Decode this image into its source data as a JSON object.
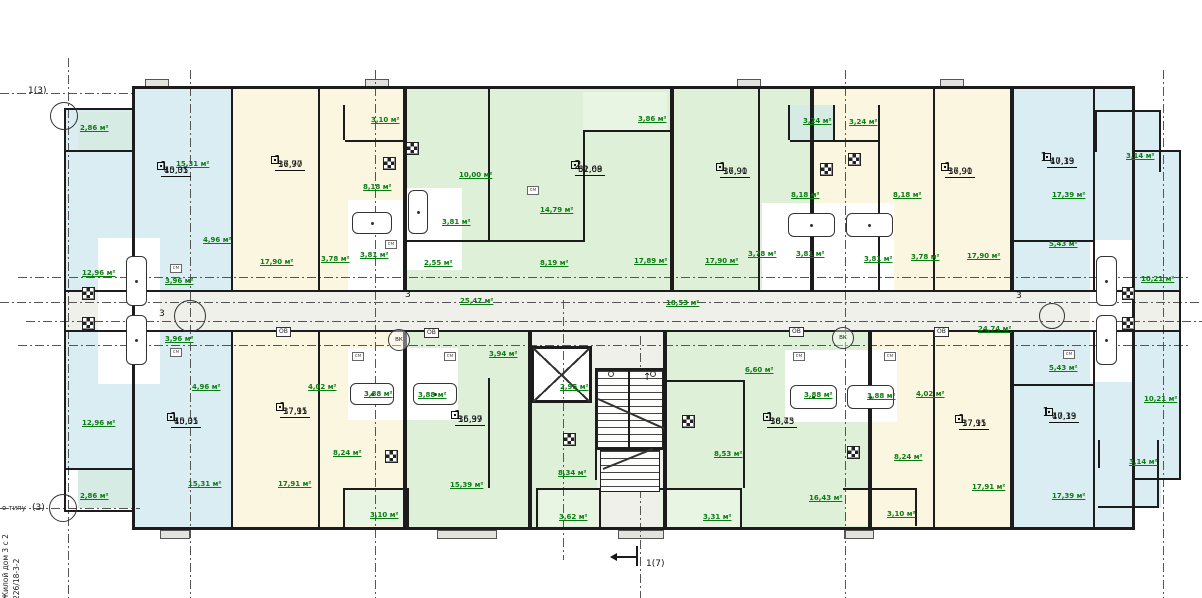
{
  "palette": {
    "blue": "#daedf3",
    "cream": "#faf6df",
    "green": "#def0d8",
    "mint": "#e8f5e3",
    "teal": "#d6ebe4",
    "gray": "#f0f0ea",
    "white": "#ffffff",
    "stub": "#e3e3de",
    "wall": "#1c1c1c",
    "label": "#0a7d12"
  },
  "title_block": {
    "side_line1": "Жилой дом 3 с 2",
    "side_line2": "226/18-3-2",
    "type_note": "о типу"
  },
  "lift": {
    "line1": "Лифт Q=630кг",
    "line2": "(АР-1н)"
  },
  "dim_label": "1.680",
  "tags": {
    "ov": "ОВ",
    "vk": "ВК",
    "sm": "см",
    "ztr": "ЗТР",
    "ov_pos": [
      [
        276,
        327
      ],
      [
        424,
        328
      ],
      [
        789,
        327
      ],
      [
        934,
        327
      ]
    ],
    "vk_pos": [
      [
        388,
        329
      ],
      [
        832,
        327
      ]
    ],
    "sm_pos": [
      [
        385,
        240
      ],
      [
        527,
        186
      ],
      [
        170,
        264
      ],
      [
        170,
        348
      ],
      [
        352,
        352
      ],
      [
        444,
        352
      ],
      [
        793,
        352
      ],
      [
        884,
        352
      ],
      [
        1063,
        350
      ]
    ]
  },
  "apartments": [
    {
      "n": "1",
      "a1": "15,31",
      "a2": "40,05",
      "x": 160,
      "y": 166,
      "side": "left"
    },
    {
      "n": "1",
      "a1": "17,90",
      "a2": "36,77",
      "x": 274,
      "y": 160,
      "side": "left"
    },
    {
      "n": "2",
      "a1": "32,68",
      "a2": "61,09",
      "x": 574,
      "y": 165,
      "side": "left"
    },
    {
      "n": "1",
      "a1": "17,90",
      "a2": "36,91",
      "x": 719,
      "y": 167,
      "side": "left"
    },
    {
      "n": "1",
      "a1": "17,90",
      "a2": "36,91",
      "x": 944,
      "y": 167,
      "side": "left"
    },
    {
      "n": "1",
      "a1": "17,39",
      "a2": "40,13",
      "x": 1048,
      "y": 157,
      "side": "right"
    },
    {
      "n": "1",
      "a1": "15,31",
      "a2": "40,05",
      "x": 170,
      "y": 417,
      "side": "left"
    },
    {
      "n": "1",
      "a1": "17,91",
      "a2": "37,15",
      "x": 279,
      "y": 407,
      "side": "left"
    },
    {
      "n": "1",
      "a1": "15,99",
      "a2": "36,37",
      "x": 454,
      "y": 415,
      "side": "left"
    },
    {
      "n": "1",
      "a1": "16,43",
      "a2": "38,75",
      "x": 766,
      "y": 417,
      "side": "left"
    },
    {
      "n": "1",
      "a1": "17,91",
      "a2": "37,15",
      "x": 958,
      "y": 419,
      "side": "left"
    },
    {
      "n": "1",
      "a1": "17,39",
      "a2": "40,13",
      "x": 1050,
      "y": 412,
      "side": "right"
    }
  ],
  "area_labels": [
    {
      "t": "2,86 м²",
      "x": 80,
      "y": 124
    },
    {
      "t": "15,31 м²",
      "x": 176,
      "y": 160
    },
    {
      "t": "4,96 м²",
      "x": 203,
      "y": 236
    },
    {
      "t": "12,96 м²",
      "x": 82,
      "y": 269
    },
    {
      "t": "3,96 м²",
      "x": 165,
      "y": 277
    },
    {
      "t": "3,10 м²",
      "x": 371,
      "y": 116
    },
    {
      "t": "8,18 м²",
      "x": 363,
      "y": 183
    },
    {
      "t": "17,90 м²",
      "x": 260,
      "y": 258
    },
    {
      "t": "3,78 м²",
      "x": 321,
      "y": 255
    },
    {
      "t": "3,81 м²",
      "x": 360,
      "y": 251
    },
    {
      "t": "10,00 м²",
      "x": 459,
      "y": 171
    },
    {
      "t": "3,86 м²",
      "x": 638,
      "y": 115
    },
    {
      "t": "14,79 м²",
      "x": 540,
      "y": 206
    },
    {
      "t": "3,81 м²",
      "x": 442,
      "y": 218
    },
    {
      "t": "2,55 м²",
      "x": 424,
      "y": 259
    },
    {
      "t": "8,19 м²",
      "x": 540,
      "y": 259
    },
    {
      "t": "17,89 м²",
      "x": 634,
      "y": 257
    },
    {
      "t": "25,47 м²",
      "x": 460,
      "y": 297
    },
    {
      "t": "18,53 м²",
      "x": 666,
      "y": 299
    },
    {
      "t": "24,74 м²",
      "x": 978,
      "y": 325
    },
    {
      "t": "3,24 м²",
      "x": 803,
      "y": 117
    },
    {
      "t": "3,24 м²",
      "x": 849,
      "y": 118
    },
    {
      "t": "8,18 м²",
      "x": 791,
      "y": 191
    },
    {
      "t": "8,18 м²",
      "x": 893,
      "y": 191
    },
    {
      "t": "17,90 м²",
      "x": 705,
      "y": 257
    },
    {
      "t": "3,78 м²",
      "x": 748,
      "y": 250
    },
    {
      "t": "3,81 м²",
      "x": 796,
      "y": 250
    },
    {
      "t": "3,81 м²",
      "x": 864,
      "y": 255
    },
    {
      "t": "3,78 м²",
      "x": 911,
      "y": 253
    },
    {
      "t": "17,90 м²",
      "x": 967,
      "y": 252
    },
    {
      "t": "17,39 м²",
      "x": 1052,
      "y": 191
    },
    {
      "t": "3,14 м²",
      "x": 1126,
      "y": 152
    },
    {
      "t": "5,43 м²",
      "x": 1049,
      "y": 240
    },
    {
      "t": "10,21 м²",
      "x": 1141,
      "y": 275
    },
    {
      "t": "2,95 м²",
      "x": 560,
      "y": 383
    },
    {
      "t": "3,96 м²",
      "x": 165,
      "y": 335
    },
    {
      "t": "4,96 м²",
      "x": 192,
      "y": 383
    },
    {
      "t": "12,96 м²",
      "x": 82,
      "y": 419
    },
    {
      "t": "15,31 м²",
      "x": 188,
      "y": 480
    },
    {
      "t": "2,86 м²",
      "x": 80,
      "y": 492
    },
    {
      "t": "4,02 м²",
      "x": 308,
      "y": 383
    },
    {
      "t": "3,88 м²",
      "x": 364,
      "y": 390
    },
    {
      "t": "3,88 м²",
      "x": 418,
      "y": 391
    },
    {
      "t": "8,24 м²",
      "x": 333,
      "y": 449
    },
    {
      "t": "17,91 м²",
      "x": 278,
      "y": 480
    },
    {
      "t": "3,10 м²",
      "x": 370,
      "y": 511
    },
    {
      "t": "3,94 м²",
      "x": 489,
      "y": 350
    },
    {
      "t": "15,39 м²",
      "x": 450,
      "y": 481
    },
    {
      "t": "8,34 м²",
      "x": 558,
      "y": 469
    },
    {
      "t": "3,62 м²",
      "x": 559,
      "y": 513
    },
    {
      "t": "6,60 м²",
      "x": 745,
      "y": 366
    },
    {
      "t": "8,53 м²",
      "x": 714,
      "y": 450
    },
    {
      "t": "16,43 м²",
      "x": 809,
      "y": 494
    },
    {
      "t": "3,31 м²",
      "x": 703,
      "y": 513
    },
    {
      "t": "3,88 м²",
      "x": 804,
      "y": 391
    },
    {
      "t": "3,88 м²",
      "x": 867,
      "y": 392
    },
    {
      "t": "4,02 м²",
      "x": 916,
      "y": 390
    },
    {
      "t": "8,24 м²",
      "x": 894,
      "y": 453
    },
    {
      "t": "17,91 м²",
      "x": 972,
      "y": 483
    },
    {
      "t": "3,10 м²",
      "x": 887,
      "y": 510
    },
    {
      "t": "17,39 м²",
      "x": 1052,
      "y": 492
    },
    {
      "t": "5,43 м²",
      "x": 1049,
      "y": 364
    },
    {
      "t": "10,21 м²",
      "x": 1144,
      "y": 395
    },
    {
      "t": "3,14 м²",
      "x": 1129,
      "y": 458
    }
  ],
  "zones": [
    [
      66,
      108,
      66,
      184,
      "blue"
    ],
    [
      132,
      88,
      101,
      204,
      "blue"
    ],
    [
      233,
      88,
      172,
      204,
      "cream"
    ],
    [
      405,
      88,
      267,
      204,
      "green"
    ],
    [
      672,
      88,
      140,
      204,
      "green"
    ],
    [
      812,
      88,
      200,
      204,
      "cream"
    ],
    [
      1012,
      88,
      123,
      204,
      "blue"
    ],
    [
      1135,
      150,
      46,
      142,
      "blue"
    ],
    [
      1095,
      110,
      66,
      62,
      "blue"
    ],
    [
      78,
      112,
      54,
      38,
      "teal"
    ],
    [
      345,
      105,
      62,
      35,
      "cream"
    ],
    [
      583,
      92,
      84,
      38,
      "mint"
    ],
    [
      790,
      105,
      45,
      35,
      "teal"
    ],
    [
      835,
      105,
      45,
      35,
      "cream"
    ],
    [
      132,
      292,
      1003,
      40,
      "gray"
    ],
    [
      66,
      292,
      66,
      40,
      "gray"
    ],
    [
      1135,
      292,
      46,
      40,
      "gray"
    ],
    [
      66,
      332,
      66,
      138,
      "blue"
    ],
    [
      78,
      470,
      54,
      38,
      "teal"
    ],
    [
      132,
      332,
      101,
      198,
      "blue"
    ],
    [
      233,
      332,
      172,
      198,
      "cream"
    ],
    [
      405,
      332,
      125,
      198,
      "green"
    ],
    [
      530,
      332,
      135,
      198,
      "gray"
    ],
    [
      530,
      402,
      67,
      128,
      "green"
    ],
    [
      665,
      332,
      205,
      198,
      "green"
    ],
    [
      870,
      332,
      142,
      198,
      "cream"
    ],
    [
      1012,
      332,
      123,
      198,
      "blue"
    ],
    [
      1135,
      332,
      46,
      148,
      "blue"
    ],
    [
      1098,
      440,
      63,
      68,
      "blue"
    ],
    [
      345,
      490,
      62,
      36,
      "mint"
    ],
    [
      540,
      490,
      57,
      36,
      "mint"
    ],
    [
      660,
      490,
      80,
      38,
      "mint"
    ],
    [
      845,
      490,
      72,
      36,
      "cream"
    ],
    [
      348,
      200,
      57,
      90,
      "white"
    ],
    [
      405,
      188,
      57,
      82,
      "white"
    ],
    [
      762,
      203,
      132,
      88,
      "white"
    ],
    [
      98,
      238,
      62,
      146,
      "white"
    ],
    [
      1090,
      240,
      45,
      142,
      "white"
    ],
    [
      348,
      348,
      110,
      72,
      "white"
    ],
    [
      785,
      350,
      112,
      72,
      "white"
    ],
    [
      533,
      348,
      57,
      54,
      "white"
    ],
    [
      508,
      60,
      158,
      26,
      "white"
    ],
    [
      145,
      79,
      24,
      8,
      "stub"
    ],
    [
      365,
      79,
      24,
      8,
      "stub"
    ],
    [
      737,
      79,
      24,
      8,
      "stub"
    ],
    [
      940,
      79,
      24,
      8,
      "stub"
    ],
    [
      437,
      530,
      60,
      9,
      "stub"
    ],
    [
      618,
      530,
      46,
      9,
      "stub"
    ],
    [
      844,
      530,
      30,
      9,
      "stub"
    ],
    [
      160,
      530,
      30,
      9,
      "stub"
    ]
  ],
  "walls": [
    [
      132,
      86,
      1003,
      3
    ],
    [
      132,
      527,
      1003,
      3
    ],
    [
      132,
      86,
      3,
      444
    ],
    [
      1132,
      86,
      3,
      444
    ],
    [
      64,
      108,
      2,
      404
    ],
    [
      64,
      108,
      70,
      2
    ],
    [
      64,
      510,
      70,
      2
    ],
    [
      66,
      150,
      66,
      2
    ],
    [
      66,
      290,
      66,
      2
    ],
    [
      66,
      330,
      66,
      2
    ],
    [
      66,
      468,
      66,
      2
    ],
    [
      1179,
      150,
      2,
      330
    ],
    [
      1135,
      150,
      46,
      2
    ],
    [
      1135,
      478,
      46,
      2
    ],
    [
      1135,
      290,
      46,
      2
    ],
    [
      1135,
      330,
      46,
      2
    ],
    [
      1095,
      110,
      66,
      2
    ],
    [
      1159,
      110,
      2,
      62
    ],
    [
      1095,
      110,
      2,
      42
    ],
    [
      1098,
      506,
      61,
      2
    ],
    [
      1157,
      440,
      2,
      68
    ],
    [
      1098,
      440,
      2,
      28
    ],
    [
      132,
      290,
      1003,
      2
    ],
    [
      132,
      330,
      1003,
      2
    ],
    [
      231,
      88,
      2,
      202
    ],
    [
      318,
      88,
      2,
      202
    ],
    [
      403,
      86,
      4,
      204
    ],
    [
      488,
      88,
      2,
      154
    ],
    [
      583,
      130,
      2,
      112
    ],
    [
      670,
      86,
      4,
      204
    ],
    [
      758,
      88,
      2,
      202
    ],
    [
      810,
      86,
      4,
      204
    ],
    [
      878,
      105,
      2,
      185
    ],
    [
      933,
      88,
      2,
      202
    ],
    [
      1010,
      86,
      4,
      204
    ],
    [
      1093,
      88,
      2,
      202
    ],
    [
      343,
      105,
      2,
      35
    ],
    [
      345,
      140,
      62,
      2
    ],
    [
      583,
      130,
      89,
      2
    ],
    [
      405,
      240,
      180,
      2
    ],
    [
      790,
      140,
      90,
      2
    ],
    [
      788,
      105,
      2,
      35
    ],
    [
      833,
      105,
      2,
      35
    ],
    [
      1012,
      240,
      83,
      2
    ],
    [
      231,
      332,
      2,
      198
    ],
    [
      318,
      332,
      2,
      198
    ],
    [
      403,
      332,
      4,
      198
    ],
    [
      488,
      378,
      2,
      110
    ],
    [
      528,
      330,
      4,
      200
    ],
    [
      663,
      330,
      4,
      200
    ],
    [
      743,
      382,
      2,
      106
    ],
    [
      868,
      330,
      4,
      200
    ],
    [
      933,
      332,
      2,
      198
    ],
    [
      1010,
      330,
      4,
      200
    ],
    [
      1093,
      332,
      2,
      198
    ],
    [
      665,
      380,
      80,
      2
    ],
    [
      345,
      488,
      64,
      2
    ],
    [
      538,
      488,
      61,
      2
    ],
    [
      658,
      488,
      84,
      2
    ],
    [
      843,
      488,
      74,
      2
    ],
    [
      1012,
      384,
      83,
      2
    ],
    [
      343,
      488,
      2,
      40
    ],
    [
      407,
      488,
      2,
      40
    ],
    [
      536,
      488,
      2,
      40
    ],
    [
      599,
      488,
      2,
      40
    ],
    [
      740,
      488,
      2,
      40
    ],
    [
      915,
      488,
      2,
      38
    ],
    [
      531,
      346,
      61,
      3
    ],
    [
      531,
      400,
      61,
      3
    ],
    [
      531,
      346,
      3,
      57
    ],
    [
      589,
      346,
      3,
      57
    ],
    [
      595,
      368,
      2,
      112
    ],
    [
      597,
      448,
      66,
      2
    ],
    [
      597,
      368,
      66,
      2
    ],
    [
      612,
      556,
      26,
      2
    ],
    [
      636,
      546,
      2,
      20
    ]
  ],
  "fixtures": {
    "tubs": [
      [
        352,
        212,
        40,
        22
      ],
      [
        408,
        190,
        20,
        44
      ],
      [
        788,
        213,
        47,
        24
      ],
      [
        846,
        213,
        47,
        24
      ],
      [
        350,
        383,
        44,
        22
      ],
      [
        413,
        383,
        44,
        22
      ],
      [
        790,
        385,
        47,
        24
      ],
      [
        847,
        385,
        47,
        24
      ],
      [
        126,
        256,
        21,
        50
      ],
      [
        126,
        315,
        21,
        50
      ],
      [
        1096,
        256,
        21,
        50
      ],
      [
        1096,
        315,
        21,
        50
      ]
    ],
    "stoves": [
      [
        406,
        142
      ],
      [
        383,
        157
      ],
      [
        820,
        163
      ],
      [
        848,
        153
      ],
      [
        385,
        450
      ],
      [
        563,
        433
      ],
      [
        682,
        415
      ],
      [
        847,
        446
      ],
      [
        82,
        287
      ],
      [
        82,
        317
      ],
      [
        1122,
        287
      ],
      [
        1122,
        317
      ]
    ],
    "posts": [
      [
        608,
        371
      ],
      [
        650,
        371
      ]
    ]
  },
  "stairs": {
    "upper": [
      597,
      370,
      66,
      78
    ],
    "lower": [
      600,
      450,
      60,
      42
    ],
    "divider": [
      628,
      370,
      2,
      78
    ],
    "diag1": [
      598,
      398,
      72,
      24
    ],
    "diag2": [
      603,
      468,
      54,
      -22
    ]
  },
  "elevator": [
    533,
    348,
    57,
    54
  ],
  "axis": {
    "labels": [
      {
        "t": "1(3)",
        "x": 28,
        "y": 86
      },
      {
        "t": "(3)",
        "x": 32,
        "y": 503
      },
      {
        "t": "3",
        "x": 405,
        "y": 290
      },
      {
        "t": "3",
        "x": 1016,
        "y": 291
      },
      {
        "t": "3",
        "x": 159,
        "y": 309
      },
      {
        "t": "1(7)",
        "x": 646,
        "y": 559
      }
    ],
    "circles": [
      [
        50,
        102,
        28
      ],
      [
        49,
        494,
        28
      ],
      [
        174,
        300,
        32
      ],
      [
        1039,
        303,
        26
      ]
    ],
    "hlines": [
      [
        93,
        0,
        135
      ],
      [
        277,
        18,
        1190
      ],
      [
        302,
        0,
        1202
      ],
      [
        321,
        26,
        1202
      ],
      [
        345,
        18,
        1190
      ],
      [
        508,
        0,
        140
      ]
    ],
    "vlines": [
      [
        68,
        58,
        598
      ],
      [
        190,
        70,
        598
      ],
      [
        375,
        70,
        598
      ],
      [
        563,
        300,
        560
      ],
      [
        640,
        336,
        598
      ],
      [
        845,
        70,
        598
      ],
      [
        1163,
        70,
        598
      ]
    ]
  }
}
